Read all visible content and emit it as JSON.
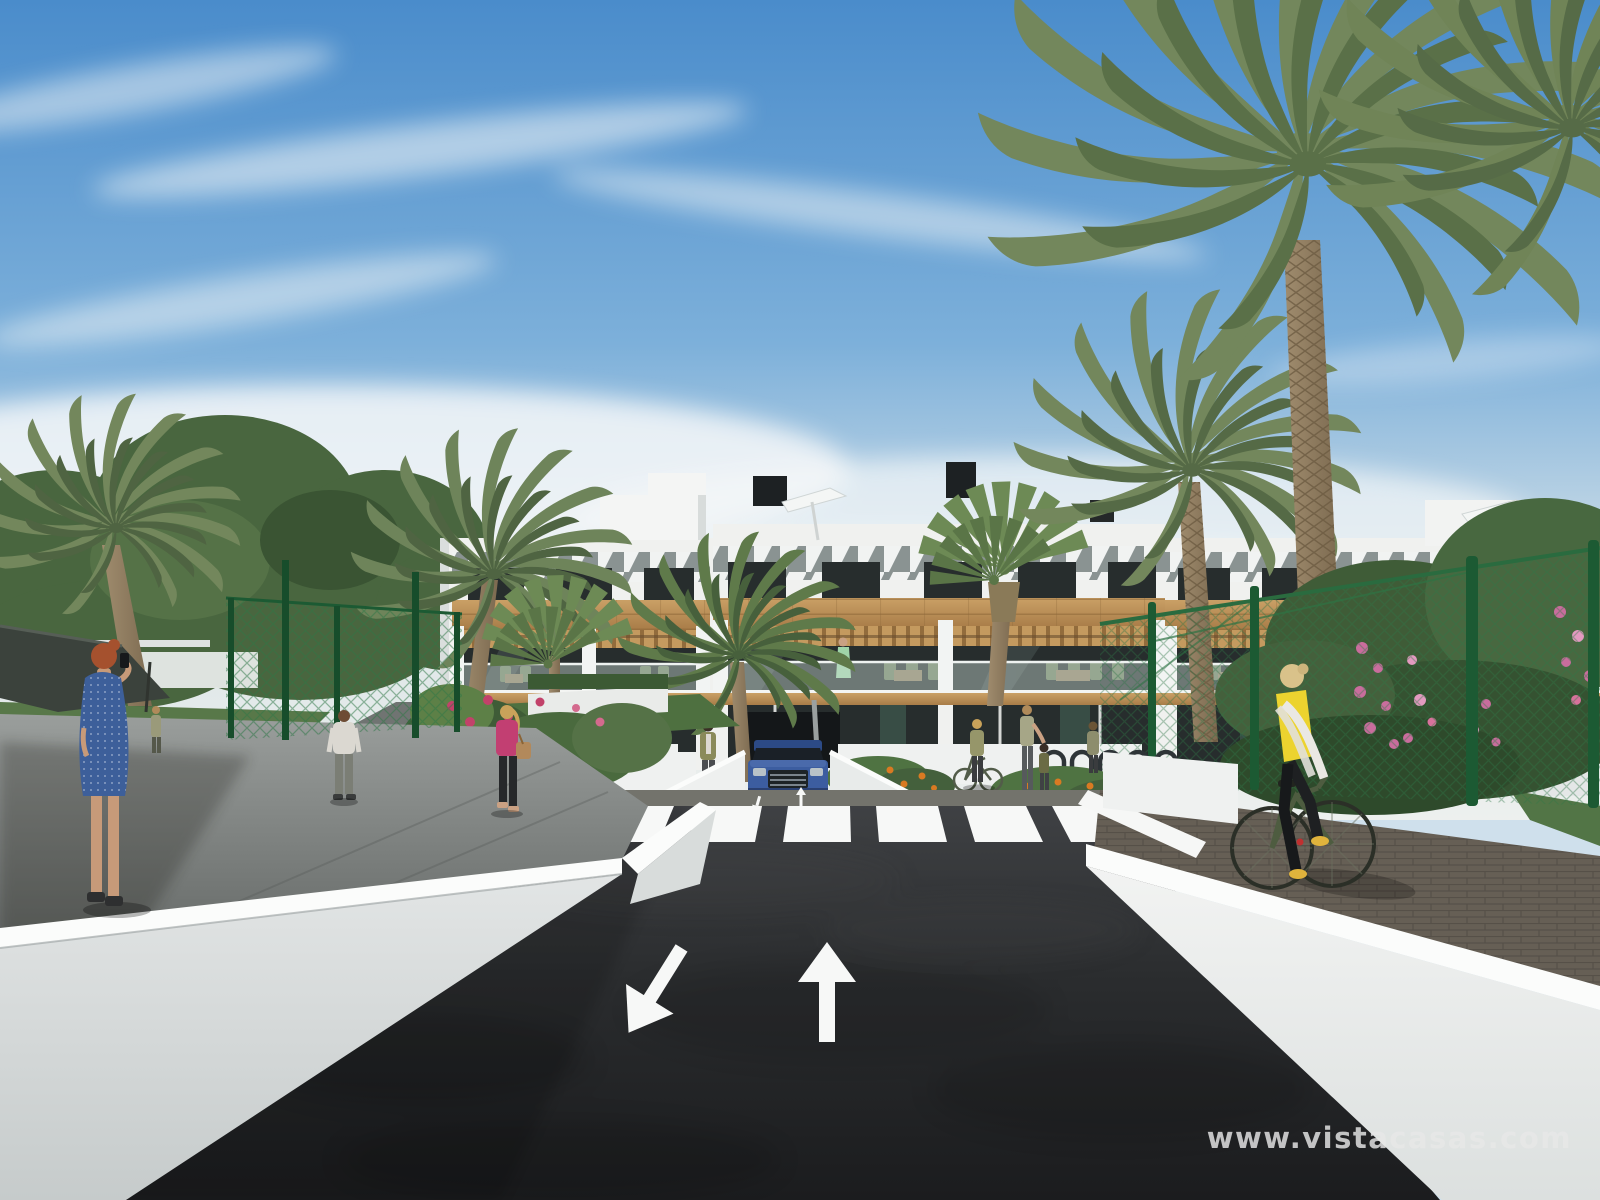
{
  "meta": {
    "type": "architectural-3d-render",
    "description": "New-build Mediterranean apartment complex render: white two/three storey block with wood cladding, slatted brise-soleil roof band, glass balconies, palm trees, a two-way asphalt access road with zebra crossing and lane arrows leading to an underground parking ramp with a blue SUV, pedestrians on side walkways and a cyclist in a yellow vest on the right paver path."
  },
  "watermark": {
    "text": "www.vistacasas.com",
    "color": "#e8e8e8",
    "opacity": 0.82
  },
  "palette": {
    "sky_top": "#4a8ccb",
    "sky_mid": "#7db0da",
    "sky_pale": "#b9d2e4",
    "sky_haze": "#dfe7e8",
    "sky_horizon": "#edf0ee",
    "cloud_white": "#f4f7f8",
    "asphalt_top": "#3f4144",
    "asphalt_mid": "#2a2c2e",
    "asphalt_dark": "#1b1c1e",
    "sidewalk_gray": "#73736c",
    "paver_brown": "#665f55",
    "building_white": "#f0f1ef",
    "wall_cap": "#fbfcfb",
    "wall_face_light": "#e2e5e5",
    "wall_face_dark": "#c6cbcb",
    "wood": "#caa066",
    "wood_dark": "#a87c48",
    "glass_dark": "#272d2d",
    "glass_green": "#3c544a",
    "balustrade_glass": "#cfe0da",
    "fence_green": "#2f7747",
    "fence_post": "#1c5a33",
    "palm_green": "#73875c",
    "palm_dark": "#4f6442",
    "tree_green": "#49663f",
    "grass_green": "#587849",
    "flower_pink": "#c96d9d",
    "flower_orange": "#d97a22",
    "flower_red": "#c2426a",
    "trunk_brown": "#9b8a70",
    "car_blue": "#3c5da0",
    "vest_yellow": "#ecd32f",
    "dress_blue": "#3d5f9a",
    "top_pink": "#c23f72",
    "jacket_olive": "#8a8a5a",
    "marking_white": "#f7f8f7",
    "canopy_dark": "#3b423c"
  },
  "scene": {
    "road": {
      "lane_arrows": [
        "towards-viewer",
        "away-from-viewer"
      ],
      "crosswalk_stripes": 6
    },
    "vehicles": [
      {
        "id": "suv",
        "color": "#3c5da0",
        "location": "underground-parking-ramp"
      }
    ],
    "people": [
      {
        "id": "woman-blue-dress",
        "desc": "red-haired woman in blue dotted dress on phone, left foreground"
      },
      {
        "id": "man-white-tshirt",
        "desc": "man walking away on left path"
      },
      {
        "id": "woman-pink-top",
        "desc": "blonde woman in pink top with handbag on left path"
      },
      {
        "id": "woman-olive-jacket",
        "desc": "woman standing left of parking ramp"
      },
      {
        "id": "woman-with-bicycle",
        "desc": "woman pushing bicycle near bike racks"
      },
      {
        "id": "adult-with-child",
        "desc": "adult with child near bike racks"
      },
      {
        "id": "woman-grey-top",
        "desc": "woman standing by bike racks"
      },
      {
        "id": "balcony-woman-green-dress",
        "desc": "woman on central first-floor balcony"
      },
      {
        "id": "balcony-couple",
        "desc": "two people on right balcony"
      },
      {
        "id": "person-blue-shirt-right",
        "desc": "person by right flower bed with blue stroller"
      },
      {
        "id": "cyclist-yellow-vest",
        "desc": "blonde woman in yellow vest on green bicycle, right walkway"
      }
    ],
    "vegetation": {
      "palms": 8,
      "deciduous_trees": "left cluster",
      "flowers": [
        "pink",
        "orange",
        "red"
      ]
    },
    "structures": [
      "apartment-building",
      "rooftop-parasols",
      "chimneys",
      "chain-link-fences",
      "retaining-walls",
      "shade-canopy",
      "bike-racks"
    ]
  }
}
